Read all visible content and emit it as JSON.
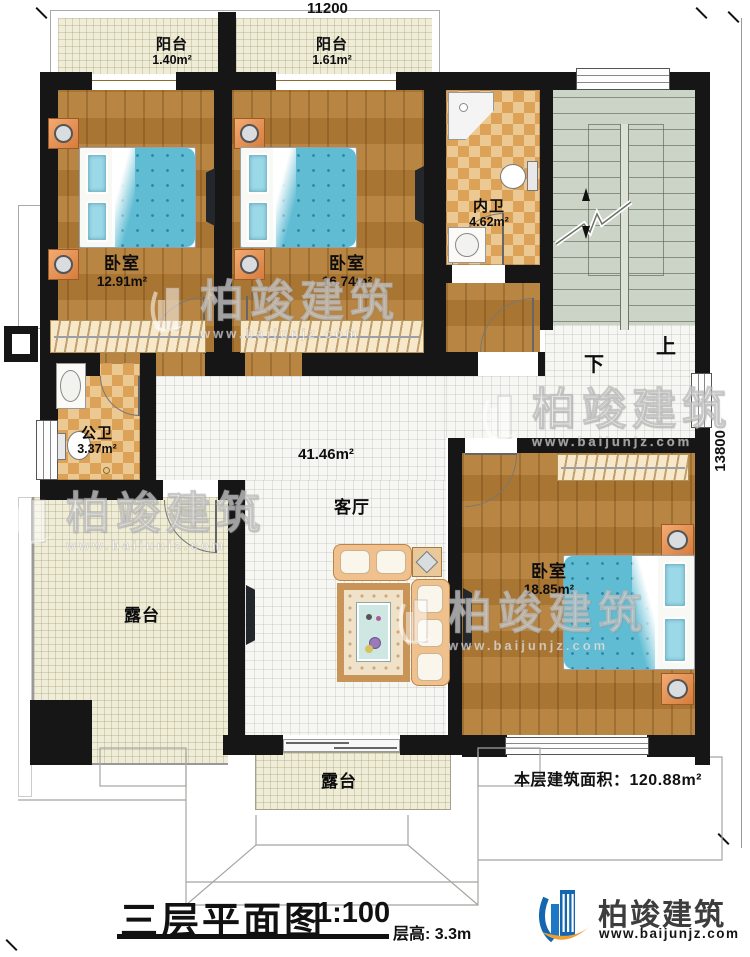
{
  "dimensions": {
    "top": "11200",
    "right": "13800"
  },
  "rooms": {
    "balcony_1": {
      "label": "阳台",
      "area": "1.40m²"
    },
    "balcony_2": {
      "label": "阳台",
      "area": "1.61m²"
    },
    "bedroom_1": {
      "label": "卧室",
      "area": "12.91m²"
    },
    "bedroom_2": {
      "label": "卧室",
      "area": "16.74m²"
    },
    "inner_bathroom": {
      "label": "内卫",
      "area": "4.62m²"
    },
    "public_bathroom": {
      "label": "公卫",
      "area": "3.37m²"
    },
    "living_room": {
      "label": "客厅",
      "area": "41.46m²"
    },
    "bedroom_3": {
      "label": "卧室",
      "area": "18.85m²"
    },
    "terrace_left": {
      "label": "露台"
    },
    "terrace_bottom": {
      "label": "露台"
    }
  },
  "stairs": {
    "up_label": "上",
    "down_label": "下"
  },
  "notes": {
    "floor_area": "本层建筑面积：120.88m²"
  },
  "title_block": {
    "title": "三层平面图",
    "scale": "1:100",
    "floor_height": "层高: 3.3m"
  },
  "branding": {
    "company": "柏竣建筑",
    "website": "www.baijunjz.com"
  },
  "watermark": {
    "company": "柏竣建筑",
    "website": "www.baijunjz.com"
  },
  "colors": {
    "wall": "#161616",
    "wood": "#b07b36",
    "checker_tile": "#dca257",
    "cream": "#efecd8",
    "stair": "#ccd3c7",
    "bed_blue": "#5fbcd3",
    "logo_blue": "#1566b0",
    "logo_orange": "#ed9f35"
  }
}
